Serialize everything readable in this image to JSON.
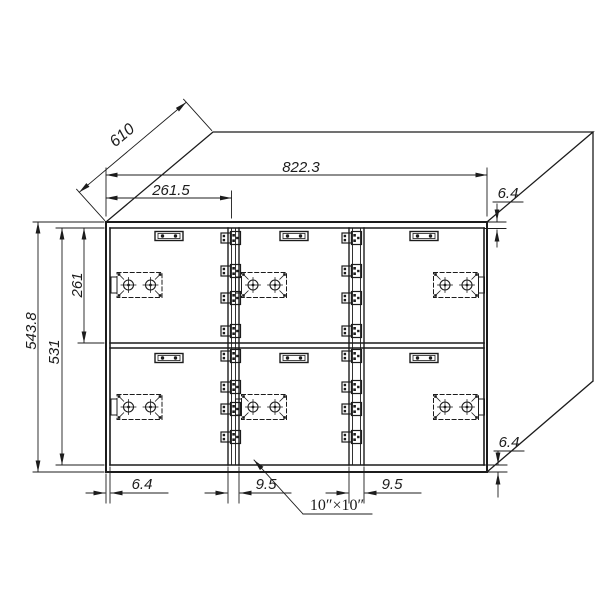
{
  "drawing": {
    "background": "#ffffff",
    "line_color": "#1c1c1c",
    "description_labels": {
      "door_size_label": "10″×10″"
    },
    "dims": {
      "depth": "610",
      "overall_width": "822.3",
      "door_width": "261.5",
      "top_frame": "6.4",
      "overall_height": "543.8",
      "inner_height": "531",
      "door_height": "261",
      "left_frame": "6.4",
      "gap_left": "9.5",
      "gap_right": "9.5",
      "bottom_frame": "6.4"
    }
  }
}
